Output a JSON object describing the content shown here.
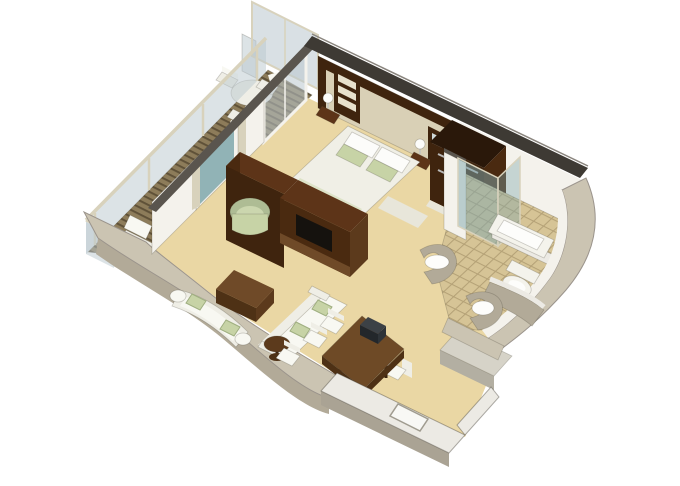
{
  "figure": {
    "kind": "isometric-3d-floor-plan",
    "subject": "one-bedroom suite with private balcony, living-dining room and bathroom",
    "visible_text": "none"
  },
  "scene": {
    "rooms": [
      {
        "name": "balcony",
        "furniture": [
          "privacy-divider-glass",
          "glass-railing",
          "round-table",
          "two-chairs",
          "lounge-chair",
          "plank-decking"
        ]
      },
      {
        "name": "bedroom",
        "furniture": [
          "double-bed",
          "white-pillows",
          "green-accent-pillows",
          "headboard-wall",
          "shelf-unit",
          "bedside-lamps",
          "balcony-glass-door"
        ]
      },
      {
        "name": "walk-in-wardrobe",
        "furniture": [
          "hanging-rails"
        ]
      },
      {
        "name": "bathroom",
        "furniture": [
          "bathtub",
          "glass-shower",
          "left-vanity-sink",
          "right-vanity-sink",
          "toilet",
          "tiled-floor"
        ]
      },
      {
        "name": "living-room",
        "furniture": [
          "tv-cabinet-divider",
          "curved-sofa",
          "straight-sofa",
          "ottoman-coffee-table",
          "round-side-table",
          "sage-armchair",
          "balcony-window"
        ]
      },
      {
        "name": "dining-area",
        "furniture": [
          "dining-table",
          "six-white-chairs",
          "dark-centerpiece"
        ]
      },
      {
        "name": "entry",
        "furniture": [
          "entry-door",
          "exterior-landing"
        ]
      }
    ]
  },
  "palette": {
    "background": "#ffffff",
    "deckBase": "#8d7c5a",
    "deckStripe": "#5f5138",
    "carpet": "#ead7a4",
    "tileBase": "#d6c496",
    "tileLine": "#b4a176",
    "glass": "#b9c7ce",
    "glassTeal": "#7fa8ad",
    "frameLight": "#d8d2bc",
    "whiteWall": "#f4f2ec",
    "wallTopDark": "#3e3a34",
    "wallTopGray": "#5a554e",
    "wallHighlight": "#8a857e",
    "taupeWall": "#cbc4b2",
    "taupeWallDark": "#b2aa98",
    "hullStroke": "#9b948c",
    "woodDarkest": "#2a180a",
    "woodDarker": "#3f240e",
    "woodDark": "#4a2a10",
    "woodMid": "#5d3418",
    "woodLight": "#6f4a28",
    "woodSide": "#5c3a1c",
    "tableTop": "#6e4a26",
    "tableEdge": "#4e3115",
    "legBrown": "#3a2410",
    "cream": "#d9d0b6",
    "cubby": "#e7e0cc",
    "whiteFurn": "#efeee6",
    "whiteFurnLight": "#f8f8f2",
    "furnStroke": "#c9c7bd",
    "sage": "#c7d3a6",
    "sageDark": "#aebc94",
    "sageLight": "#cbd6ae",
    "sageStroke": "#9fae80",
    "linen": "#f0efe6",
    "linenShadow": "#e2e0d2",
    "pillowWhite": "#fcfcfa",
    "throwGreen": "#dde3c8",
    "fixtureWhite": "#f4f3ec",
    "fixtureStroke": "#c5c3bb",
    "basinWhite": "#fdfdfb",
    "tvBlack": "#15120e",
    "centerTop": "#3c4146",
    "centerFront": "#23272b",
    "centerSide": "#2e3338",
    "entryWallTop": "#eceae4",
    "entryWallFace": "#aaa394",
    "landingTop": "#d6d3c8",
    "landingFace": "#b3afa2",
    "doorWhite": "#f8f8f5",
    "doorStroke": "#a09c90",
    "metal": "#b9b9b9",
    "mirror": "#cfd8d8",
    "threshold": "#e8e6da"
  }
}
